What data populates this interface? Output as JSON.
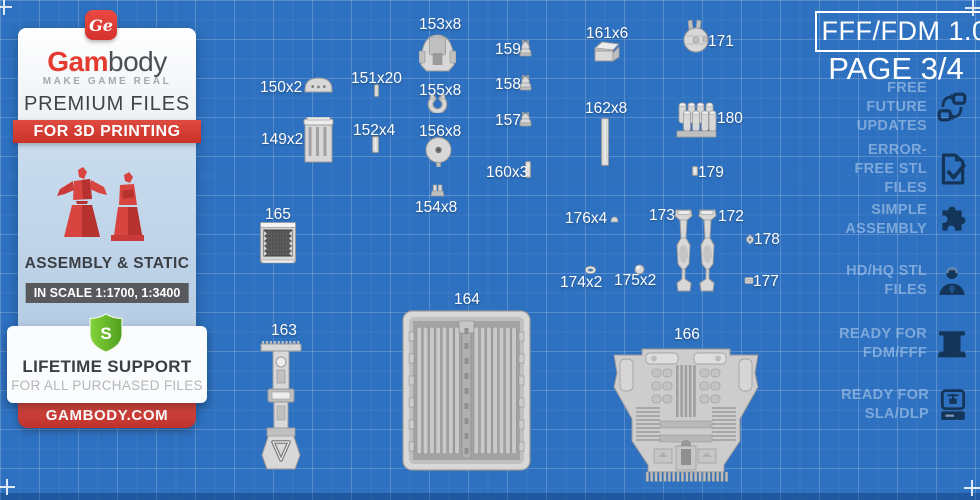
{
  "header": {
    "format_label": "FFF/FDM 1.0",
    "page_label": "PAGE 3/4"
  },
  "features": {
    "items": [
      {
        "label": "FREE FUTURE UPDATES",
        "icon": "sync-icon"
      },
      {
        "label": "ERROR-FREE STL FILES",
        "icon": "document-check-icon"
      },
      {
        "label": "SIMPLE ASSEMBLY",
        "icon": "puzzle-icon"
      },
      {
        "label": "HD/HQ STL FILES",
        "icon": "figure-icon"
      },
      {
        "label": "READY FOR FDM/FFF",
        "icon": "fdm-printer-icon"
      },
      {
        "label": "READY FOR SLA/DLP",
        "icon": "sla-printer-icon"
      }
    ]
  },
  "sidebar": {
    "logo_monogram": "Ge",
    "brand_bold": "Gam",
    "brand_rest": "body",
    "tagline": "MAKE GAME REAL",
    "premium": "PREMIUM FILES",
    "ribbon": "FOR 3D PRINTING",
    "assembly": "ASSEMBLY & STATIC",
    "scale": "IN SCALE 1:1700, 1:3400",
    "shield_letter": "S",
    "support_title": "LIFETIME SUPPORT",
    "support_sub": "FOR ALL PURCHASED FILES",
    "site": "GAMBODY.COM"
  },
  "colors": {
    "background": "#2e71c0",
    "accent_red": "#d93b35",
    "shield_green": "#63b82e",
    "icon_navy": "#14355a",
    "figure_bg": "#c4d8ea"
  },
  "parts": [
    {
      "label": "150x2",
      "shape": "dome",
      "lx": 260,
      "ly": 79,
      "px": 304,
      "py": 77,
      "pw": 29,
      "ph": 16
    },
    {
      "label": "149x2",
      "shape": "column",
      "lx": 261,
      "ly": 131,
      "px": 303,
      "py": 117,
      "pw": 31,
      "ph": 47
    },
    {
      "label": "151x20",
      "shape": "pin",
      "lx": 351,
      "ly": 70,
      "px": 374,
      "py": 84,
      "pw": 5,
      "ph": 13
    },
    {
      "label": "152x4",
      "shape": "rod",
      "lx": 353,
      "ly": 122,
      "px": 372,
      "py": 136,
      "pw": 7,
      "ph": 17
    },
    {
      "label": "153x8",
      "shape": "turret",
      "lx": 419,
      "ly": 16,
      "px": 419,
      "py": 33,
      "pw": 37,
      "ph": 40
    },
    {
      "label": "155x8",
      "shape": "clamp",
      "lx": 419,
      "ly": 82,
      "px": 427,
      "py": 94,
      "pw": 21,
      "ph": 19
    },
    {
      "label": "156x8",
      "shape": "disc",
      "lx": 419,
      "ly": 123,
      "px": 424,
      "py": 137,
      "pw": 29,
      "ph": 30
    },
    {
      "label": "154x8",
      "shape": "bracket",
      "lx": 415,
      "ly": 199,
      "px": 429,
      "py": 184,
      "pw": 17,
      "ph": 13
    },
    {
      "label": "159",
      "shape": "knob",
      "lx": 495,
      "ly": 41,
      "px": 517,
      "py": 39,
      "pw": 17,
      "ph": 18
    },
    {
      "label": "158",
      "shape": "knob",
      "lx": 495,
      "ly": 76,
      "px": 517,
      "py": 74,
      "pw": 17,
      "ph": 17
    },
    {
      "label": "157",
      "shape": "knob",
      "lx": 495,
      "ly": 112,
      "px": 517,
      "py": 111,
      "pw": 17,
      "ph": 16
    },
    {
      "label": "160x3",
      "shape": "rod",
      "lx": 486,
      "ly": 164,
      "px": 525,
      "py": 161,
      "pw": 6,
      "ph": 17
    },
    {
      "label": "161x6",
      "shape": "box",
      "lx": 586,
      "ly": 25,
      "px": 592,
      "py": 39,
      "pw": 30,
      "ph": 24
    },
    {
      "label": "162x8",
      "shape": "rod",
      "lx": 585,
      "ly": 100,
      "px": 601,
      "py": 118,
      "pw": 8,
      "ph": 48
    },
    {
      "label": "171",
      "shape": "falcon",
      "lx": 708,
      "ly": 33,
      "px": 683,
      "py": 20,
      "pw": 26,
      "ph": 33
    },
    {
      "label": "180",
      "shape": "cluster",
      "lx": 717,
      "ly": 110,
      "px": 676,
      "py": 101,
      "pw": 41,
      "ph": 37
    },
    {
      "label": "179",
      "shape": "rod",
      "lx": 698,
      "ly": 164,
      "px": 692,
      "py": 166,
      "pw": 6,
      "ph": 10
    },
    {
      "label": "165",
      "shape": "grille",
      "lx": 265,
      "ly": 206,
      "px": 260,
      "py": 222,
      "pw": 36,
      "ph": 42
    },
    {
      "label": "176x4",
      "shape": "smalldome",
      "lx": 565,
      "ly": 210,
      "px": 610,
      "py": 216,
      "pw": 9,
      "ph": 7
    },
    {
      "label": "173",
      "shape": "leg",
      "lx": 649,
      "ly": 207,
      "px": 673,
      "py": 209,
      "pw": 21,
      "ph": 83
    },
    {
      "label": "172",
      "shape": "legm",
      "lx": 718,
      "ly": 208,
      "px": 695,
      "py": 209,
      "pw": 23,
      "ph": 83
    },
    {
      "label": "178",
      "shape": "cog",
      "lx": 754,
      "ly": 231,
      "px": 745,
      "py": 235,
      "pw": 10,
      "ph": 9
    },
    {
      "label": "174x2",
      "shape": "ring",
      "lx": 560,
      "ly": 274,
      "px": 585,
      "py": 266,
      "pw": 11,
      "ph": 8
    },
    {
      "label": "175x2",
      "shape": "ball",
      "lx": 614,
      "ly": 272,
      "px": 634,
      "py": 264,
      "pw": 11,
      "ph": 11
    },
    {
      "label": "177",
      "shape": "blocklet",
      "lx": 753,
      "ly": 273,
      "px": 744,
      "py": 276,
      "pw": 10,
      "ph": 9
    },
    {
      "label": "163",
      "shape": "tower",
      "lx": 271,
      "ly": 322,
      "px": 259,
      "py": 338,
      "pw": 44,
      "ph": 132
    },
    {
      "label": "164",
      "shape": "tray",
      "lx": 454,
      "ly": 291,
      "px": 402,
      "py": 310,
      "pw": 129,
      "ph": 161
    },
    {
      "label": "166",
      "shape": "engine",
      "lx": 674,
      "ly": 326,
      "px": 612,
      "py": 345,
      "pw": 148,
      "ph": 139
    }
  ]
}
